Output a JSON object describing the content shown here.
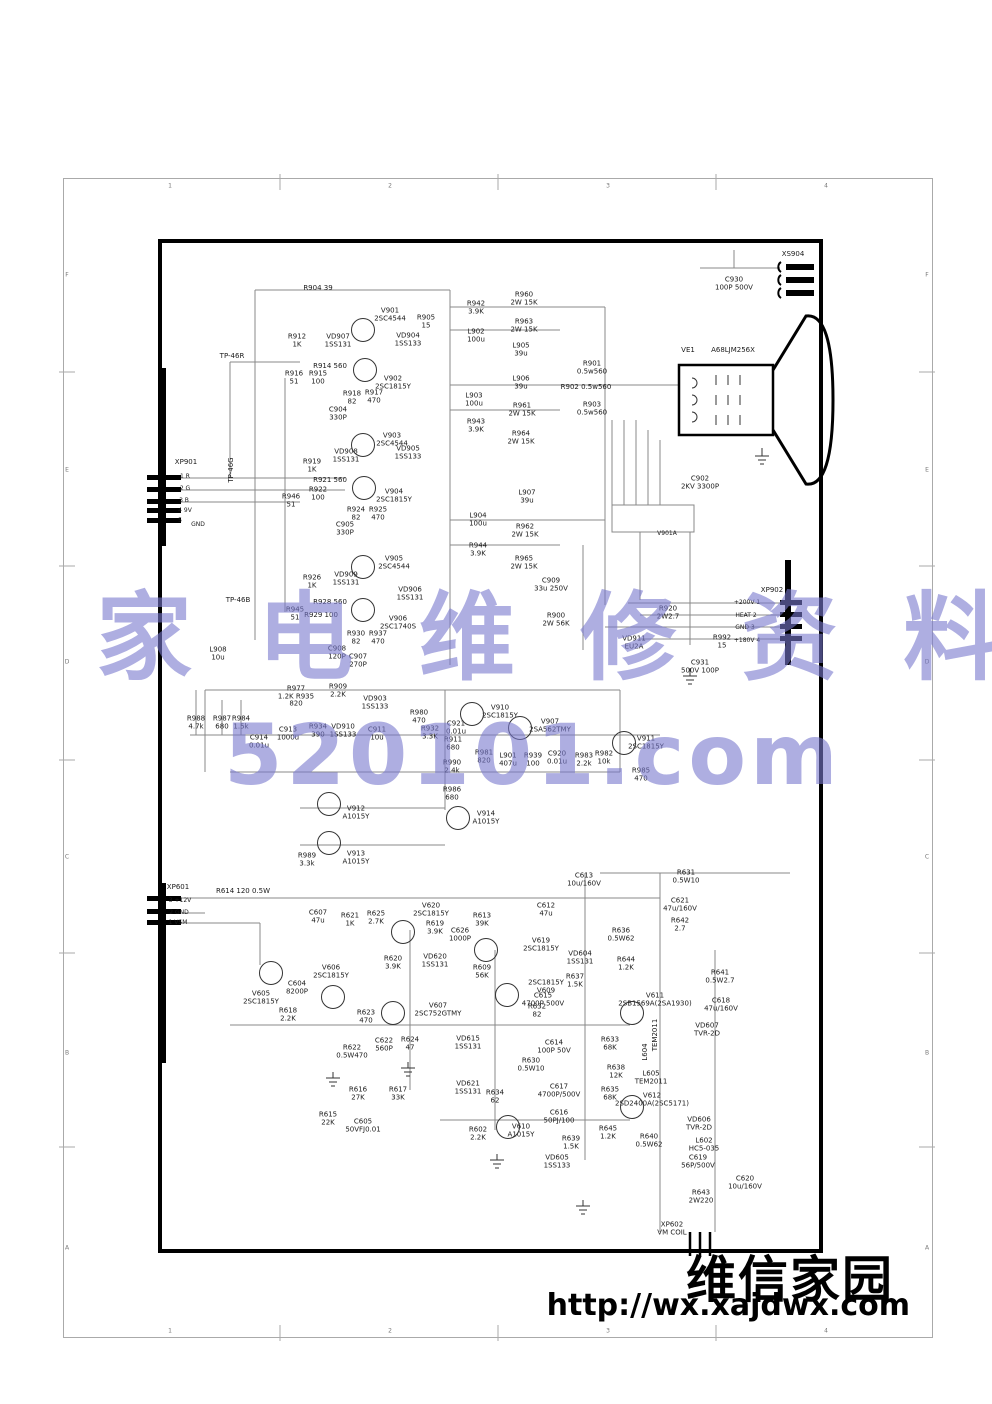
{
  "frame": {
    "cols": [
      {
        "l": "1",
        "x": 170
      },
      {
        "l": "2",
        "x": 390
      },
      {
        "l": "3",
        "x": 608
      },
      {
        "l": "4",
        "x": 826
      }
    ],
    "col_y_top": 186,
    "col_y_bottom": 1331,
    "rows": [
      {
        "l": "F",
        "y": 275
      },
      {
        "l": "E",
        "y": 470
      },
      {
        "l": "D",
        "y": 662
      },
      {
        "l": "C",
        "y": 857
      },
      {
        "l": "B",
        "y": 1053
      },
      {
        "l": "A",
        "y": 1248
      }
    ],
    "row_x_left": 67,
    "row_x_right": 927
  },
  "watermark": {
    "line1": "家 电 维 修 资 料 网",
    "line2": "520101.com",
    "color": "#7878cd"
  },
  "branding": {
    "site_name": "维信家园",
    "url": "http://wx.xajdwx.com"
  },
  "crt": {
    "ref": "VE1",
    "model": "A68LJM256X"
  },
  "transistors": [
    [
      363,
      330
    ],
    [
      365,
      370
    ],
    [
      363,
      445
    ],
    [
      364,
      488
    ],
    [
      363,
      567
    ],
    [
      363,
      610
    ],
    [
      472,
      714
    ],
    [
      520,
      728
    ],
    [
      624,
      743
    ],
    [
      329,
      804
    ],
    [
      329,
      843
    ],
    [
      458,
      818
    ],
    [
      271,
      973
    ],
    [
      333,
      997
    ],
    [
      403,
      932
    ],
    [
      486,
      950
    ],
    [
      507,
      995
    ],
    [
      393,
      1013
    ],
    [
      508,
      1127
    ],
    [
      632,
      1013
    ],
    [
      632,
      1107
    ]
  ],
  "labels": [
    {
      "t": "R904  39",
      "x": 318,
      "y": 289
    },
    {
      "t": "V901\n2SC4544",
      "x": 390,
      "y": 315
    },
    {
      "t": "R905\n15",
      "x": 426,
      "y": 322
    },
    {
      "t": "R912\n1K",
      "x": 297,
      "y": 341
    },
    {
      "t": "VD907\n1SS131",
      "x": 338,
      "y": 341
    },
    {
      "t": "VD904\n1SS133",
      "x": 408,
      "y": 340
    },
    {
      "t": "R914 560",
      "x": 330,
      "y": 367
    },
    {
      "t": "V902\n2SC1815Y",
      "x": 393,
      "y": 383
    },
    {
      "t": "R916\n51",
      "x": 294,
      "y": 378
    },
    {
      "t": "R915\n100",
      "x": 318,
      "y": 378
    },
    {
      "t": "R918\n82",
      "x": 352,
      "y": 398
    },
    {
      "t": "R917\n470",
      "x": 374,
      "y": 397
    },
    {
      "t": "C904\n330P",
      "x": 338,
      "y": 414
    },
    {
      "t": "TP-46R",
      "x": 232,
      "y": 357
    },
    {
      "t": "TP-46G",
      "x": 232,
      "y": 470,
      "rot": 1
    },
    {
      "t": "TP-46B",
      "x": 238,
      "y": 601
    },
    {
      "t": "XP901",
      "x": 186,
      "y": 463
    },
    {
      "t": "1  R",
      "x": 185,
      "y": 477,
      "fs": 6
    },
    {
      "t": "2  G",
      "x": 185,
      "y": 489,
      "fs": 6
    },
    {
      "t": "3  B",
      "x": 184,
      "y": 501,
      "fs": 6
    },
    {
      "t": "4  9V",
      "x": 185,
      "y": 511,
      "fs": 6
    },
    {
      "t": "5",
      "x": 180,
      "y": 521,
      "fs": 6
    },
    {
      "t": "GND",
      "x": 198,
      "y": 525,
      "fs": 6
    },
    {
      "t": "V903\n2SC4544",
      "x": 392,
      "y": 440
    },
    {
      "t": "VD908\n1SS131",
      "x": 346,
      "y": 456
    },
    {
      "t": "VD905\n1SS133",
      "x": 408,
      "y": 453
    },
    {
      "t": "R919\n1K",
      "x": 312,
      "y": 466
    },
    {
      "t": "R921 560",
      "x": 330,
      "y": 481
    },
    {
      "t": "R922\n100",
      "x": 318,
      "y": 494
    },
    {
      "t": "R946\n51",
      "x": 291,
      "y": 501
    },
    {
      "t": "V904\n2SC1815Y",
      "x": 394,
      "y": 496
    },
    {
      "t": "R924\n82",
      "x": 356,
      "y": 514
    },
    {
      "t": "R925\n470",
      "x": 378,
      "y": 514
    },
    {
      "t": "C905\n330P",
      "x": 345,
      "y": 529
    },
    {
      "t": "V905\n2SC4544",
      "x": 394,
      "y": 563
    },
    {
      "t": "R926\n1K",
      "x": 312,
      "y": 582
    },
    {
      "t": "VD909\n1SS131",
      "x": 346,
      "y": 579
    },
    {
      "t": "VD906\n1SS131",
      "x": 410,
      "y": 594
    },
    {
      "t": "R928 560",
      "x": 330,
      "y": 603
    },
    {
      "t": "R945\n51",
      "x": 295,
      "y": 614
    },
    {
      "t": "R929 100",
      "x": 321,
      "y": 616
    },
    {
      "t": "V906\n2SC1740S",
      "x": 398,
      "y": 623
    },
    {
      "t": "R930\n82",
      "x": 356,
      "y": 638
    },
    {
      "t": "R937\n470",
      "x": 378,
      "y": 638
    },
    {
      "t": "C908\n120P",
      "x": 337,
      "y": 653
    },
    {
      "t": "C907\n270P",
      "x": 358,
      "y": 661
    },
    {
      "t": "L908\n10u",
      "x": 218,
      "y": 654
    },
    {
      "t": "R942\n3.9K",
      "x": 476,
      "y": 308
    },
    {
      "t": "R960\n2W 15K",
      "x": 524,
      "y": 299
    },
    {
      "t": "R963\n2W 15K",
      "x": 524,
      "y": 326
    },
    {
      "t": "L902\n100u",
      "x": 476,
      "y": 336
    },
    {
      "t": "L905\n39u",
      "x": 521,
      "y": 350
    },
    {
      "t": "L906\n39u",
      "x": 521,
      "y": 383
    },
    {
      "t": "L903\n100u",
      "x": 474,
      "y": 400
    },
    {
      "t": "R961\n2W 15K",
      "x": 522,
      "y": 410
    },
    {
      "t": "R943\n3.9K",
      "x": 476,
      "y": 426
    },
    {
      "t": "R964\n2W 15K",
      "x": 521,
      "y": 438
    },
    {
      "t": "R901\n0.5w560",
      "x": 592,
      "y": 368
    },
    {
      "t": "R902  0.5w560",
      "x": 586,
      "y": 388
    },
    {
      "t": "R903\n0.5w560",
      "x": 592,
      "y": 409
    },
    {
      "t": "L907\n39u",
      "x": 527,
      "y": 497
    },
    {
      "t": "L904\n100u",
      "x": 478,
      "y": 520
    },
    {
      "t": "R962\n2W 15K",
      "x": 525,
      "y": 531
    },
    {
      "t": "R944\n3.9K",
      "x": 478,
      "y": 550
    },
    {
      "t": "R965\n2W 15K",
      "x": 524,
      "y": 563
    },
    {
      "t": "C909\n33u 250V",
      "x": 551,
      "y": 585
    },
    {
      "t": "R900\n2W 56K",
      "x": 556,
      "y": 620
    },
    {
      "t": "XS904",
      "x": 793,
      "y": 255
    },
    {
      "t": "C930\n100P 500V",
      "x": 734,
      "y": 284
    },
    {
      "t": "C902\n2KV 3300P",
      "x": 700,
      "y": 483
    },
    {
      "t": "V901A",
      "x": 667,
      "y": 534,
      "fs": 6
    },
    {
      "t": "XP902",
      "x": 772,
      "y": 591
    },
    {
      "t": "+200V  1",
      "x": 747,
      "y": 603,
      "fs": 6
    },
    {
      "t": "HEAT  2",
      "x": 746,
      "y": 616,
      "fs": 6
    },
    {
      "t": "GND  3",
      "x": 745,
      "y": 628,
      "fs": 6
    },
    {
      "t": "+180V  4",
      "x": 747,
      "y": 641,
      "fs": 6
    },
    {
      "t": "R920\n2W2.7",
      "x": 668,
      "y": 613
    },
    {
      "t": "VD911\nEU2A",
      "x": 634,
      "y": 643
    },
    {
      "t": "R992\n15",
      "x": 722,
      "y": 642
    },
    {
      "t": "C931\n500V 100P",
      "x": 700,
      "y": 667
    },
    {
      "t": "R977\n1.2K R935\n820",
      "x": 296,
      "y": 697
    },
    {
      "t": "R909\n2.2K",
      "x": 338,
      "y": 691
    },
    {
      "t": "VD903\n1SS133",
      "x": 375,
      "y": 703
    },
    {
      "t": "R988\n4.7k",
      "x": 196,
      "y": 723
    },
    {
      "t": "R987\n680",
      "x": 222,
      "y": 723
    },
    {
      "t": "R984\n1.5k",
      "x": 241,
      "y": 723
    },
    {
      "t": "C913\n1000u",
      "x": 288,
      "y": 734
    },
    {
      "t": "C914\n0.01u",
      "x": 259,
      "y": 742
    },
    {
      "t": "R934\n390",
      "x": 318,
      "y": 731
    },
    {
      "t": "VD910\n1SS133",
      "x": 343,
      "y": 731
    },
    {
      "t": "C911\n10u",
      "x": 377,
      "y": 734
    },
    {
      "t": "R980\n470",
      "x": 419,
      "y": 717
    },
    {
      "t": "R932\n3.3K",
      "x": 430,
      "y": 733
    },
    {
      "t": "V910\n2SC1815Y",
      "x": 500,
      "y": 712
    },
    {
      "t": "C921\n0.01u",
      "x": 456,
      "y": 728
    },
    {
      "t": "R911\n680",
      "x": 453,
      "y": 744
    },
    {
      "t": "R981\n820",
      "x": 484,
      "y": 757
    },
    {
      "t": "R990\n2.4k",
      "x": 452,
      "y": 767
    },
    {
      "t": "R986\n680",
      "x": 452,
      "y": 794
    },
    {
      "t": "V907\n2SA562TMY",
      "x": 550,
      "y": 726
    },
    {
      "t": "L901\n407u",
      "x": 508,
      "y": 760
    },
    {
      "t": "R939\n100",
      "x": 533,
      "y": 760
    },
    {
      "t": "C920\n0.01u",
      "x": 557,
      "y": 758
    },
    {
      "t": "R983\n2.2k",
      "x": 584,
      "y": 760
    },
    {
      "t": "R982\n10k",
      "x": 604,
      "y": 758
    },
    {
      "t": "V911\n2SC1815Y",
      "x": 646,
      "y": 743
    },
    {
      "t": "R985\n470",
      "x": 641,
      "y": 775
    },
    {
      "t": "V912\nA1015Y",
      "x": 356,
      "y": 813
    },
    {
      "t": "V914\nA1015Y",
      "x": 486,
      "y": 818
    },
    {
      "t": "V913\nA1015Y",
      "x": 356,
      "y": 858
    },
    {
      "t": "R989\n3.3k",
      "x": 307,
      "y": 860
    },
    {
      "t": "XP601",
      "x": 178,
      "y": 888
    },
    {
      "t": "3  +12V",
      "x": 180,
      "y": 901,
      "fs": 6
    },
    {
      "t": "2  GND",
      "x": 179,
      "y": 913,
      "fs": 6
    },
    {
      "t": "1  VSM",
      "x": 178,
      "y": 923,
      "fs": 6
    },
    {
      "t": "R614  120 0.5W",
      "x": 243,
      "y": 892
    },
    {
      "t": "C607\n47u",
      "x": 318,
      "y": 917
    },
    {
      "t": "R621\n1K",
      "x": 350,
      "y": 920
    },
    {
      "t": "R625\n2.7K",
      "x": 376,
      "y": 918
    },
    {
      "t": "V620\n2SC1815Y",
      "x": 431,
      "y": 910
    },
    {
      "t": "R619\n3.9K",
      "x": 435,
      "y": 928
    },
    {
      "t": "C626\n1000P",
      "x": 460,
      "y": 935
    },
    {
      "t": "R613\n39K",
      "x": 482,
      "y": 920
    },
    {
      "t": "C612\n47u",
      "x": 546,
      "y": 910
    },
    {
      "t": "V619\n2SC1815Y",
      "x": 541,
      "y": 945
    },
    {
      "t": "VD620\n1SS131",
      "x": 435,
      "y": 961
    },
    {
      "t": "R620\n3.9K",
      "x": 393,
      "y": 963
    },
    {
      "t": "R609\n56K",
      "x": 482,
      "y": 972
    },
    {
      "t": "2SC1815Y\nV609",
      "x": 546,
      "y": 987
    },
    {
      "t": "V605\n2SC1815Y",
      "x": 261,
      "y": 998
    },
    {
      "t": "C604\n8200P",
      "x": 297,
      "y": 988
    },
    {
      "t": "V606\n2SC1815Y",
      "x": 331,
      "y": 972
    },
    {
      "t": "R618\n2.2K",
      "x": 288,
      "y": 1015
    },
    {
      "t": "R623\n470",
      "x": 366,
      "y": 1017
    },
    {
      "t": "V607\n2SC752GTMY",
      "x": 438,
      "y": 1010
    },
    {
      "t": "R622\n0.5W470",
      "x": 352,
      "y": 1052
    },
    {
      "t": "C622\n560P",
      "x": 384,
      "y": 1045
    },
    {
      "t": "R624\n47",
      "x": 410,
      "y": 1044
    },
    {
      "t": "VD615\n1SS131",
      "x": 468,
      "y": 1043
    },
    {
      "t": "R632\n82",
      "x": 537,
      "y": 1011
    },
    {
      "t": "C614\n100P 50V",
      "x": 554,
      "y": 1047
    },
    {
      "t": "R630\n0.5W10",
      "x": 531,
      "y": 1065
    },
    {
      "t": "VD621\n1SS131",
      "x": 468,
      "y": 1088
    },
    {
      "t": "R634\n62",
      "x": 495,
      "y": 1097
    },
    {
      "t": "C617\n4700P/500V",
      "x": 559,
      "y": 1091
    },
    {
      "t": "C616\n50PJ/100",
      "x": 559,
      "y": 1117
    },
    {
      "t": "R602\n2.2K",
      "x": 478,
      "y": 1134
    },
    {
      "t": "V610\nA1015Y",
      "x": 521,
      "y": 1131
    },
    {
      "t": "R639\n1.5K",
      "x": 571,
      "y": 1143
    },
    {
      "t": "VD605\n1SS133",
      "x": 557,
      "y": 1162
    },
    {
      "t": "R645\n1.2K",
      "x": 608,
      "y": 1133
    },
    {
      "t": "R633\n68K",
      "x": 610,
      "y": 1044
    },
    {
      "t": "R638\n12K",
      "x": 616,
      "y": 1072
    },
    {
      "t": "R635\n68K",
      "x": 610,
      "y": 1094
    },
    {
      "t": "R640\n0.5W62",
      "x": 649,
      "y": 1141
    },
    {
      "t": "V611\n2SB1569A(2SA1930)",
      "x": 655,
      "y": 1000
    },
    {
      "t": "TEM2011",
      "x": 656,
      "y": 1035,
      "rot": 1
    },
    {
      "t": "L604",
      "x": 646,
      "y": 1052,
      "rot": 1
    },
    {
      "t": "L605\nTEM2011",
      "x": 651,
      "y": 1078
    },
    {
      "t": "V612\n2SD2400A(2SC5171)",
      "x": 652,
      "y": 1100
    },
    {
      "t": "VD607\nTVR-2D",
      "x": 707,
      "y": 1030
    },
    {
      "t": "VD606\nTVR-2D",
      "x": 699,
      "y": 1124
    },
    {
      "t": "L602\nHC5-035",
      "x": 704,
      "y": 1145
    },
    {
      "t": "C619\n56P/500V",
      "x": 698,
      "y": 1162
    },
    {
      "t": "C620\n10u/160V",
      "x": 745,
      "y": 1183
    },
    {
      "t": "R643\n2W220",
      "x": 701,
      "y": 1197
    },
    {
      "t": "XP602\nVM COIL",
      "x": 672,
      "y": 1229
    },
    {
      "t": "C613\n10u/160V",
      "x": 584,
      "y": 880
    },
    {
      "t": "R631\n0.5W10",
      "x": 686,
      "y": 877
    },
    {
      "t": "C621\n47u/160V",
      "x": 680,
      "y": 905
    },
    {
      "t": "R642\n2.7",
      "x": 680,
      "y": 925
    },
    {
      "t": "R636\n0.5W62",
      "x": 621,
      "y": 935
    },
    {
      "t": "VD604\n1SS131",
      "x": 580,
      "y": 958
    },
    {
      "t": "R644\n1.2K",
      "x": 626,
      "y": 964
    },
    {
      "t": "R637\n1.5K",
      "x": 575,
      "y": 981
    },
    {
      "t": "C615\n4700P 500V",
      "x": 543,
      "y": 1000
    },
    {
      "t": "R641\n0.5W2.7",
      "x": 720,
      "y": 977
    },
    {
      "t": "C618\n47u/160V",
      "x": 721,
      "y": 1005
    },
    {
      "t": "R616\n27K",
      "x": 358,
      "y": 1094
    },
    {
      "t": "R617\n33K",
      "x": 398,
      "y": 1094
    },
    {
      "t": "R615\n22K",
      "x": 328,
      "y": 1119
    },
    {
      "t": "C605\n50VFJ0.01",
      "x": 363,
      "y": 1126
    }
  ]
}
